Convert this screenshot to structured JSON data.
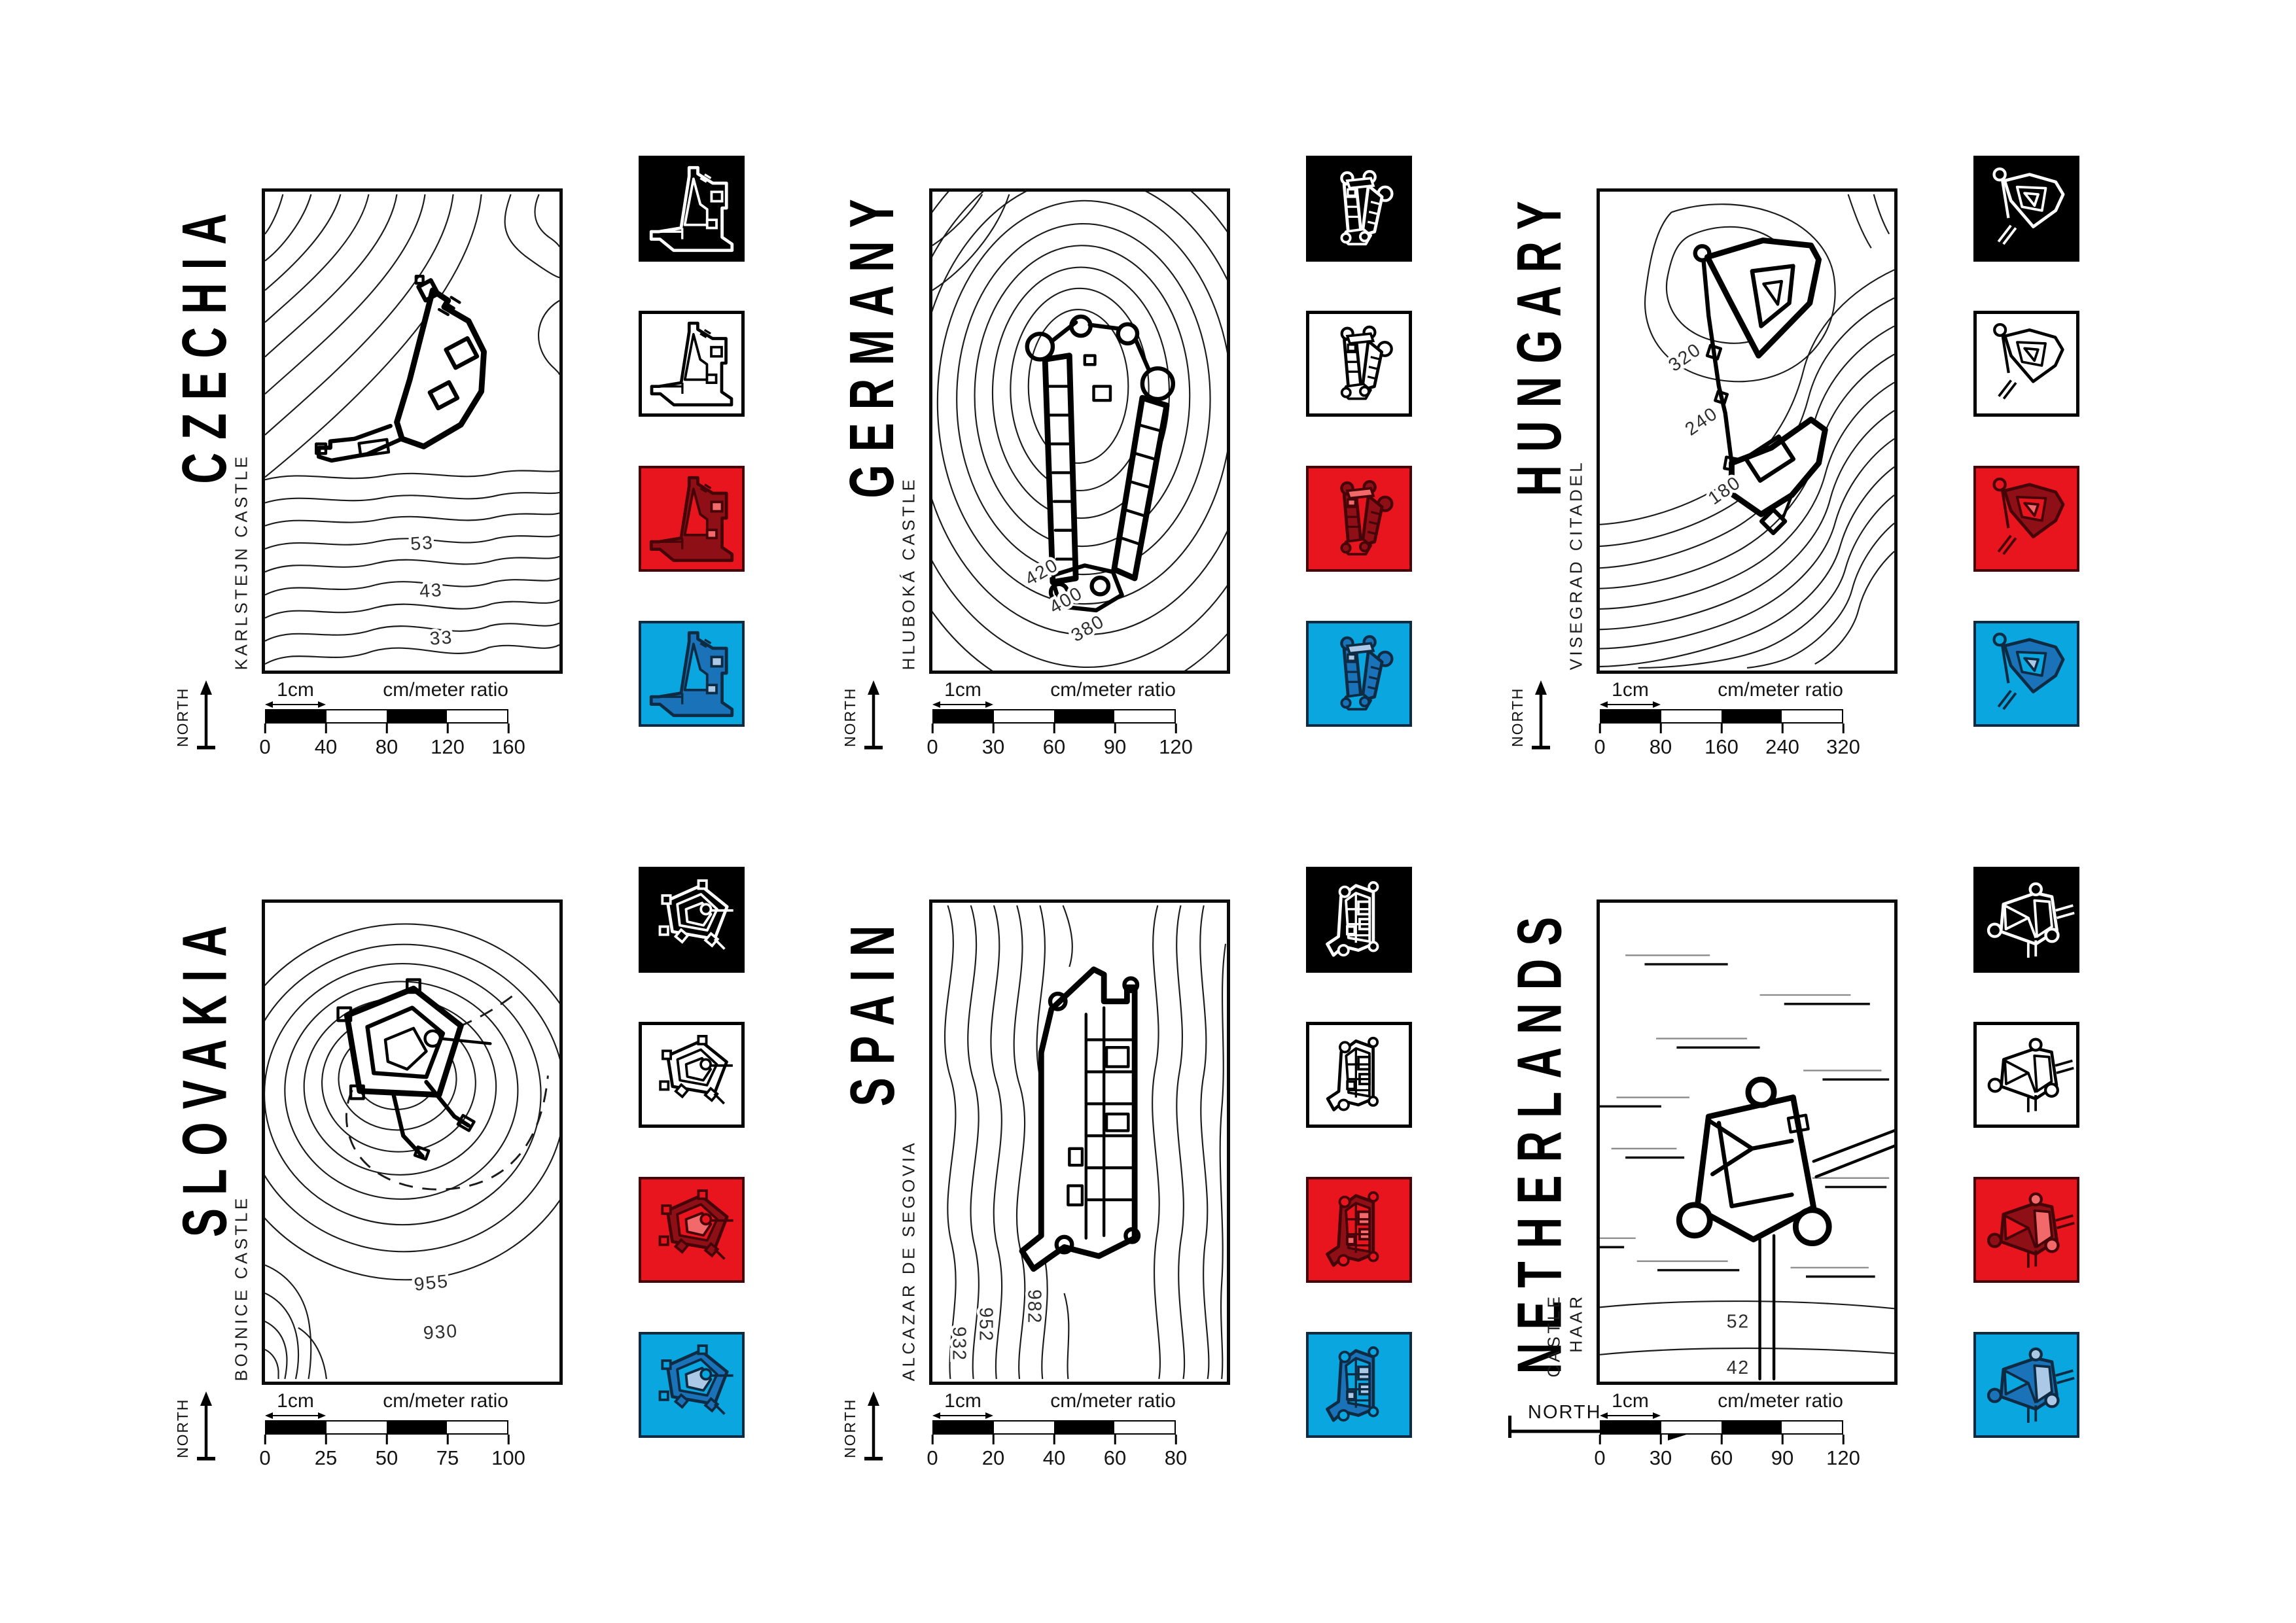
{
  "shared": {
    "unit_label": "1cm",
    "ratio_label": "cm/meter ratio",
    "north_label": "NORTH"
  },
  "colors": {
    "ink": "#000000",
    "paper": "#ffffff",
    "red_bg": "#E8151F",
    "red_dark": "#8E1016",
    "red_light": "#F1696B",
    "blue_bg": "#0AA6DF",
    "blue_dark": "#1A73B9",
    "blue_light": "#ABC9E7"
  },
  "panels": [
    {
      "country": "CZECHIA",
      "castle": "KARLSTEJN CASTLE",
      "contour_labels": [
        "53",
        "43",
        "33"
      ],
      "scale_ticks": [
        "0",
        "40",
        "80",
        "120",
        "160"
      ],
      "north_orientation": "up",
      "icon_variants": [
        "black",
        "white",
        "red",
        "blue"
      ]
    },
    {
      "country": "GERMANY",
      "castle": "HLUBOKÁ CASTLE",
      "contour_labels": [
        "420",
        "400",
        "380"
      ],
      "scale_ticks": [
        "0",
        "30",
        "60",
        "90",
        "120"
      ],
      "north_orientation": "up",
      "icon_variants": [
        "black",
        "white",
        "red",
        "blue"
      ]
    },
    {
      "country": "HUNGARY",
      "castle": "VISEGRAD CITADEL",
      "contour_labels": [
        "320",
        "240",
        "180"
      ],
      "scale_ticks": [
        "0",
        "80",
        "160",
        "240",
        "320"
      ],
      "north_orientation": "up",
      "icon_variants": [
        "black",
        "white",
        "red",
        "blue"
      ]
    },
    {
      "country": "SLOVAKIA",
      "castle": "BOJNICE CASTLE",
      "contour_labels": [
        "955",
        "930"
      ],
      "scale_ticks": [
        "0",
        "25",
        "50",
        "75",
        "100"
      ],
      "north_orientation": "up",
      "icon_variants": [
        "black",
        "white",
        "red",
        "blue"
      ]
    },
    {
      "country": "SPAIN",
      "castle": "ALCAZAR DE SEGOVIA",
      "contour_labels": [
        "982",
        "952",
        "932"
      ],
      "scale_ticks": [
        "0",
        "20",
        "40",
        "60",
        "80"
      ],
      "north_orientation": "up",
      "icon_variants": [
        "black",
        "white",
        "red",
        "blue"
      ]
    },
    {
      "country": "NETHERLANDS",
      "castle": "CASTLE\nHAAR",
      "contour_labels": [
        "52",
        "42"
      ],
      "scale_ticks": [
        "0",
        "30",
        "60",
        "90",
        "120"
      ],
      "north_orientation": "right",
      "icon_variants": [
        "black",
        "white",
        "red",
        "blue"
      ]
    }
  ]
}
